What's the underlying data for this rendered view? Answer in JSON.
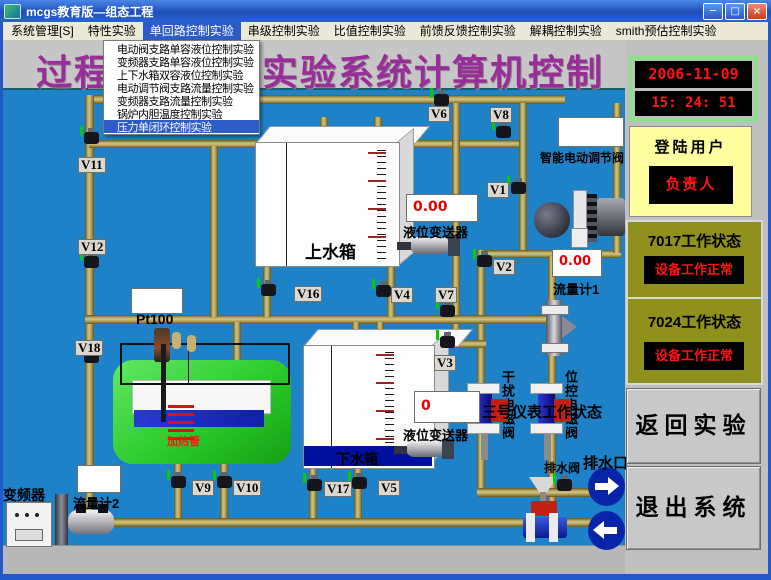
{
  "window": {
    "title": "mcgs教育版—组态工程",
    "minimize": "─",
    "maximize": "□",
    "close": "×"
  },
  "menubar": {
    "items": [
      {
        "label": "系统管理[S]"
      },
      {
        "label": "特性实验"
      },
      {
        "label": "单回路控制实验"
      },
      {
        "label": "串级控制实验"
      },
      {
        "label": "比值控制实验"
      },
      {
        "label": "前馈反馈控制实验"
      },
      {
        "label": "解耦控制实验"
      },
      {
        "label": "smith预估控制实验"
      }
    ]
  },
  "dropdown": {
    "items": [
      {
        "label": "电动阀支路单容液位控制实验"
      },
      {
        "label": "变频器支路单容液位控制实验"
      },
      {
        "label": "上下水箱双容液位控制实验"
      },
      {
        "label": "电动调节阀支路流量控制实验"
      },
      {
        "label": "变频器支路流量控制实验"
      },
      {
        "label": "锅炉内胆温度控制实验"
      },
      {
        "label": "压力单闭环控制实验"
      }
    ]
  },
  "banner": {
    "left": "过程",
    "right": "实验系统计算机控制"
  },
  "clock": {
    "date": "2006-11-09",
    "time": "15: 24: 51"
  },
  "login": {
    "label": "登陆用户",
    "user": "负责人"
  },
  "status": [
    {
      "label": "7017工作状态",
      "value": "设备工作正常"
    },
    {
      "label": "7024工作状态",
      "value": "设备工作正常"
    }
  ],
  "buttons": {
    "back": "返回实验",
    "exit": "退出系统"
  },
  "diagram": {
    "valve_labels": [
      "V6",
      "V8",
      "V11",
      "V1",
      "V12",
      "V16",
      "V4",
      "V7",
      "V2",
      "V3",
      "V18",
      "V9",
      "V10",
      "V17",
      "V5"
    ],
    "upper_tank": "上水箱",
    "lower_tank": "下水箱",
    "upper_level_display": "0.00",
    "upper_level_label": "液位变送器",
    "lower_level_display": "0",
    "lower_level_label": "液位变送器",
    "flow1_display": "0.00",
    "flow1_label": "流量计1",
    "flow2_label": "流量计2",
    "smart_valve_label": "智能电动调节阀",
    "pt100_label": "Pt100",
    "heater_label": "加热管",
    "inverter_label": "变频器",
    "drain_valve_label": "排水阀",
    "drain_outlet_label": "排水口",
    "left_solenoid_label": "干扰电磁阀",
    "right_solenoid_label": "位控电磁阀",
    "meter_status_text": "三号仪表工作状态"
  },
  "colors": {
    "canvas_blue": "#1e82c8",
    "pipe_tan": "#a89a52",
    "title_purple": "#9a2d9a",
    "status_olive": "#90901c",
    "login_yellow": "#ffffa0",
    "lcd_red": "#ff1414",
    "tank_green": "#2fd12f",
    "highlight_blue": "#2e5cc6"
  }
}
